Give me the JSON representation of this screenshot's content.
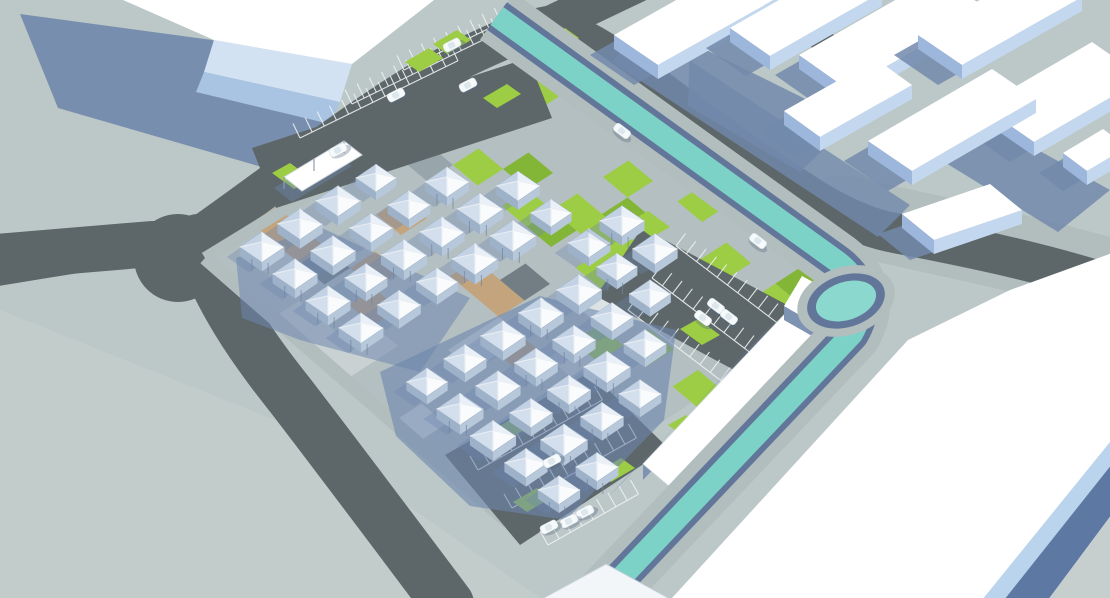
{
  "scene": {
    "title": "Aerial 3D architectural render: modular pyramid-roof housing cluster on a patchwork plaza, ring roads, canal and surrounding white buildings",
    "palette": {
      "ground": "#bcc7c7",
      "groundLight": "#c6cfce",
      "siteBase": "#b4bfc1",
      "sidewalk": "#b2bdbe",
      "road": "#5d6668",
      "shadowBlue": "#7289ab",
      "shadowDeep": "#6d86ae",
      "canalBank": "#b2bdbe",
      "canalWall": "#62769a",
      "water": "#7dd2c8",
      "waterBright": "#8bd8cf",
      "white": "#ffffff",
      "roofBandLight": "#d3e2f3",
      "roofBandMed": "#a9c3e2",
      "faceSlate": "#7e92b2",
      "slabFace": "#c3d8ef",
      "slabEnd": "#9db7dc",
      "green": "#9ccd44",
      "greenDark": "#83b637",
      "tan": "#c3a47d",
      "patchLight": "#c9d1d2",
      "patchGrayM": "#98a6ac",
      "patchGrayD": "#727e83",
      "patchWhite": "#dde3e4",
      "moduleFaceN": "#c2d2e4",
      "moduleFaceW": "#d3dfec",
      "moduleFaceE": "#e9f0f7",
      "moduleFaceS": "#f9fbfd",
      "moduleUnderL": "#9db1c9",
      "moduleUnderR": "#b7c8da",
      "moduleEdge": "#9fb2c6",
      "carBody": "#f7fafb",
      "carGlass": "#dce7ee",
      "lineWhite": "#eef2f3",
      "cornerBlue": "#b9d4ec",
      "cornerSlate": "#5d79a3",
      "doorDark": "#3c4654"
    },
    "ground_light_patch": [
      [
        0,
        310
      ],
      [
        300,
        430
      ],
      [
        540,
        598
      ],
      [
        0,
        598
      ]
    ],
    "tl_building": {
      "shadow": [
        [
          20,
          14
        ],
        [
          212,
          40
        ],
        [
          338,
          102
        ],
        [
          300,
          178
        ],
        [
          58,
          108
        ]
      ],
      "roof": [
        [
          123,
          0
        ],
        [
          434,
          0
        ],
        [
          352,
          64
        ],
        [
          214,
          40
        ]
      ],
      "band1": [
        [
          214,
          40
        ],
        [
          352,
          64
        ],
        [
          340,
          102
        ],
        [
          204,
          72
        ]
      ],
      "band2": [
        [
          204,
          72
        ],
        [
          340,
          102
        ],
        [
          330,
          124
        ],
        [
          196,
          92
        ]
      ]
    },
    "roads": {
      "verge_right": "M 840 214 C 940 236 1030 254 1118 280",
      "ring": "M -15 268 C 80 252 160 240 200 236 C 280 180 380 100 455 62 C 500 40 525 30 548 26 C 575 32 610 55 640 76 C 700 122 760 165 815 200 C 845 218 870 228 890 232 C 940 242 1030 258 1118 287",
      "left": "M -15 258 L 152 244",
      "south": "M 198 240 C 220 300 250 345 290 395 C 340 460 400 540 448 604",
      "top_stub": "M 548 26 L 636 -16",
      "topright_stub": "M 762 -12 L 826 44"
    },
    "shadow_band_canal_ne": [
      [
        640,
        28
      ],
      [
        910,
        205
      ],
      [
        878,
        237
      ],
      [
        612,
        62
      ]
    ],
    "ne_shadow_blobs": [
      [
        [
          690,
          42
        ],
        [
          852,
          122
        ],
        [
          800,
          172
        ],
        [
          688,
          106
        ]
      ],
      [
        [
          948,
          100
        ],
        [
          1110,
          190
        ],
        [
          1058,
          232
        ],
        [
          928,
          152
        ]
      ]
    ],
    "site": {
      "base": [
        [
          205,
          258
        ],
        [
          558,
          42
        ],
        [
          862,
          292
        ],
        [
          508,
          522
        ]
      ],
      "clip": [
        [
          212,
          258
        ],
        [
          556,
          48
        ],
        [
          854,
          292
        ],
        [
          510,
          514
        ]
      ],
      "grid_origin": [
        225,
        258
      ],
      "grid_u": [
        24.5,
        20.5
      ],
      "grid_v": [
        25.5,
        -16.5
      ],
      "grid_ni": 16,
      "grid_nj": 15,
      "sidewalks": [
        {
          "d": "M 205 258 L 558 42",
          "w": 12
        },
        {
          "d": "M 205 258 L 508 522",
          "w": 14
        },
        {
          "d": "M 558 42 L 862 292",
          "w": 24
        }
      ]
    },
    "parking_lots": [
      {
        "name": "parking-lot-northwest",
        "pts": [
          [
            252,
            148
          ],
          [
            528,
            58
          ],
          [
            552,
            118
          ],
          [
            276,
            208
          ]
        ]
      },
      {
        "name": "parking-lot-east",
        "pts": [
          [
            642,
            228
          ],
          [
            838,
            332
          ],
          [
            790,
            400
          ],
          [
            596,
            296
          ]
        ]
      },
      {
        "name": "parking-lot-south",
        "pts": [
          [
            445,
            455
          ],
          [
            590,
            372
          ],
          [
            668,
            448
          ],
          [
            520,
            545
          ]
        ]
      }
    ],
    "combs": [
      {
        "x": 300,
        "y": 138,
        "dx": 0.9,
        "dy": -0.44,
        "n": 13,
        "sp": 13.5,
        "tx": -7,
        "ty": -14.5
      },
      {
        "x": 352,
        "y": 104,
        "dx": 0.9,
        "dy": -0.44,
        "n": 13,
        "sp": 13.5,
        "tx": -7,
        "ty": -14.5
      },
      {
        "x": 404,
        "y": 70,
        "dx": 0.9,
        "dy": -0.44,
        "n": 10,
        "sp": 13.5,
        "tx": -7,
        "ty": -14.5
      },
      {
        "x": 676,
        "y": 246,
        "dx": 0.79,
        "dy": 0.6,
        "n": 12,
        "sp": 13,
        "tx": 9.6,
        "ty": -12.6
      },
      {
        "x": 652,
        "y": 278,
        "dx": 0.79,
        "dy": 0.6,
        "n": 12,
        "sp": 13,
        "tx": 9.6,
        "ty": -12.6
      },
      {
        "x": 628,
        "y": 310,
        "dx": 0.79,
        "dy": 0.6,
        "n": 12,
        "sp": 13,
        "tx": 9.6,
        "ty": -12.6
      },
      {
        "x": 478,
        "y": 470,
        "dx": 0.87,
        "dy": -0.49,
        "n": 11,
        "sp": 13,
        "tx": -8,
        "ty": -14
      },
      {
        "x": 512,
        "y": 508,
        "dx": 0.87,
        "dy": -0.49,
        "n": 11,
        "sp": 13,
        "tx": -8,
        "ty": -14
      },
      {
        "x": 548,
        "y": 545,
        "dx": 0.87,
        "dy": -0.49,
        "n": 8,
        "sp": 13,
        "tx": -8,
        "ty": -14
      }
    ],
    "green_strips": [
      {
        "x": 424,
        "y": 60,
        "d": "b"
      },
      {
        "x": 452,
        "y": 42,
        "d": "b"
      },
      {
        "x": 502,
        "y": 96,
        "d": "b"
      },
      {
        "x": 610,
        "y": 94,
        "d": "b"
      },
      {
        "x": 560,
        "y": 40,
        "d": "b"
      },
      {
        "x": 505,
        "y": 432,
        "d": "b"
      },
      {
        "x": 532,
        "y": 500,
        "d": "b"
      },
      {
        "x": 616,
        "y": 470,
        "d": "b"
      },
      {
        "x": 650,
        "y": 224,
        "d": "a"
      },
      {
        "x": 700,
        "y": 332,
        "d": "a"
      },
      {
        "x": 737,
        "y": 395,
        "d": "a"
      },
      {
        "x": 688,
        "y": 428,
        "d": "a"
      },
      {
        "x": 292,
        "y": 176,
        "d": "a"
      }
    ],
    "cluster_shadows": [
      {
        "pts": [
          [
            236,
            258
          ],
          [
            318,
            226
          ],
          [
            470,
            298
          ],
          [
            420,
            372
          ],
          [
            300,
            340
          ],
          [
            242,
            318
          ]
        ],
        "op": 0.55
      },
      {
        "pts": [
          [
            380,
            372
          ],
          [
            540,
            296
          ],
          [
            676,
            330
          ],
          [
            664,
            420
          ],
          [
            566,
            520
          ],
          [
            470,
            506
          ],
          [
            396,
            436
          ]
        ],
        "op": 0.6
      }
    ],
    "modules": {
      "size": 1.0,
      "positions": [
        [
          262,
          247
        ],
        [
          300,
          224
        ],
        [
          338,
          201
        ],
        [
          376,
          178
        ],
        [
          295,
          274
        ],
        [
          333,
          251
        ],
        [
          371,
          228
        ],
        [
          409,
          205
        ],
        [
          447,
          182
        ],
        [
          328,
          301
        ],
        [
          366,
          278
        ],
        [
          404,
          255
        ],
        [
          442,
          232
        ],
        [
          480,
          209
        ],
        [
          518,
          186
        ],
        [
          361,
          328
        ],
        [
          399,
          305
        ],
        [
          437,
          282
        ],
        [
          475,
          259
        ],
        [
          513,
          236
        ],
        [
          551,
          213
        ],
        [
          589,
          243
        ],
        [
          622,
          221
        ],
        [
          655,
          249
        ],
        [
          427,
          382
        ],
        [
          465,
          359
        ],
        [
          503,
          336
        ],
        [
          541,
          313
        ],
        [
          579,
          290
        ],
        [
          617,
          267
        ],
        [
          460,
          409
        ],
        [
          498,
          386
        ],
        [
          536,
          363
        ],
        [
          574,
          340
        ],
        [
          612,
          317
        ],
        [
          650,
          294
        ],
        [
          493,
          436
        ],
        [
          531,
          413
        ],
        [
          569,
          390
        ],
        [
          607,
          367
        ],
        [
          645,
          344
        ],
        [
          526,
          463
        ],
        [
          564,
          440
        ],
        [
          602,
          417
        ],
        [
          640,
          394
        ],
        [
          559,
          490
        ],
        [
          597,
          467
        ]
      ]
    },
    "canopy": {
      "shadow": [
        [
          274,
          188
        ],
        [
          334,
          152
        ],
        [
          352,
          166
        ],
        [
          292,
          202
        ]
      ],
      "roof": [
        [
          284,
          177
        ],
        [
          344,
          141
        ],
        [
          362,
          155
        ],
        [
          302,
          191
        ]
      ]
    },
    "warehouse": {
      "shadow": [
        [
          778,
          318
        ],
        [
          623,
          482
        ],
        [
          605,
          500
        ],
        [
          762,
          336
        ]
      ],
      "roof": [
        [
          798,
          300
        ],
        [
          824,
          322
        ],
        [
          669,
          486
        ],
        [
          643,
          464
        ]
      ],
      "face": [
        [
          798,
          300
        ],
        [
          643,
          464
        ],
        [
          643,
          480
        ],
        [
          798,
          316
        ]
      ],
      "box_roof": [
        [
          802,
          276
        ],
        [
          846,
          300
        ],
        [
          826,
          330
        ],
        [
          784,
          306
        ]
      ],
      "box_face": [
        [
          784,
          306
        ],
        [
          826,
          330
        ],
        [
          826,
          344
        ],
        [
          784,
          320
        ]
      ]
    },
    "canal": {
      "path": "M 497 16 L 838 262 Q 876 292 852 334 L 598 602",
      "bank_w": 58,
      "wall_w": 34,
      "water_w": 22,
      "pool": {
        "cx": 846,
        "cy": 301,
        "rot": -18,
        "bank": [
          50,
          34
        ],
        "wall": [
          40,
          26
        ],
        "water": [
          31,
          19
        ]
      }
    },
    "br_building": {
      "roof": [
        [
          672,
          598
        ],
        [
          908,
          340
        ],
        [
          1010,
          290
        ],
        [
          1115,
          252
        ],
        [
          1115,
          598
        ]
      ],
      "corner_blue": [
        [
          1110,
          442
        ],
        [
          1112,
          464
        ],
        [
          1004,
          600
        ],
        [
          982,
          600
        ]
      ],
      "corner_slate": [
        [
          1112,
          464
        ],
        [
          1112,
          514
        ],
        [
          1048,
          600
        ],
        [
          1004,
          600
        ]
      ],
      "corner_ground": [
        [
          1112,
          514
        ],
        [
          1112,
          600
        ],
        [
          1048,
          600
        ]
      ]
    },
    "bottom_sliver": [
      [
        540,
        600
      ],
      [
        606,
        564
      ],
      [
        672,
        600
      ]
    ],
    "ne_slabs": [
      {
        "c": [
          700,
          14
        ],
        "hl": [
          64,
          -36
        ],
        "hw": [
          22,
          15
        ]
      },
      {
        "c": [
          806,
          10
        ],
        "hl": [
          56,
          -32
        ],
        "hw": [
          20,
          14
        ]
      },
      {
        "c": [
          893,
          32
        ],
        "hl": [
          70,
          -40
        ],
        "hw": [
          24,
          17
        ]
      },
      {
        "c": [
          1000,
          16
        ],
        "hl": [
          60,
          -34
        ],
        "hw": [
          22,
          15
        ]
      },
      {
        "c": [
          1063,
          92
        ],
        "hl": [
          55,
          -32
        ],
        "hw": [
          26,
          18
        ]
      },
      {
        "c": [
          952,
          120
        ],
        "hl": [
          62,
          -36
        ],
        "hw": [
          22,
          15
        ]
      },
      {
        "c": [
          848,
          98
        ],
        "hl": [
          46,
          -26
        ],
        "hw": [
          18,
          13
        ]
      },
      {
        "c": [
          962,
          212
        ],
        "hl": [
          44,
          -15
        ],
        "hw": [
          16,
          13
        ]
      },
      {
        "c": [
          1095,
          150
        ],
        "hl": [
          20,
          -12
        ],
        "hw": [
          12,
          9
        ]
      }
    ],
    "vehicles": [
      {
        "x": 452,
        "y": 45,
        "a": -27
      },
      {
        "x": 622,
        "y": 131,
        "a": 37
      },
      {
        "x": 758,
        "y": 241,
        "a": 37
      },
      {
        "x": 396,
        "y": 95,
        "a": -27
      },
      {
        "x": 468,
        "y": 85,
        "a": -27
      },
      {
        "x": 338,
        "y": 150,
        "a": -27
      },
      {
        "x": 716,
        "y": 306,
        "a": 37
      },
      {
        "x": 729,
        "y": 317,
        "a": 37
      },
      {
        "x": 703,
        "y": 318,
        "a": 37
      },
      {
        "x": 552,
        "y": 461,
        "a": -27
      },
      {
        "x": 585,
        "y": 512,
        "a": -27
      },
      {
        "x": 569,
        "y": 521,
        "a": -27
      },
      {
        "x": 549,
        "y": 527,
        "a": -27
      }
    ]
  }
}
